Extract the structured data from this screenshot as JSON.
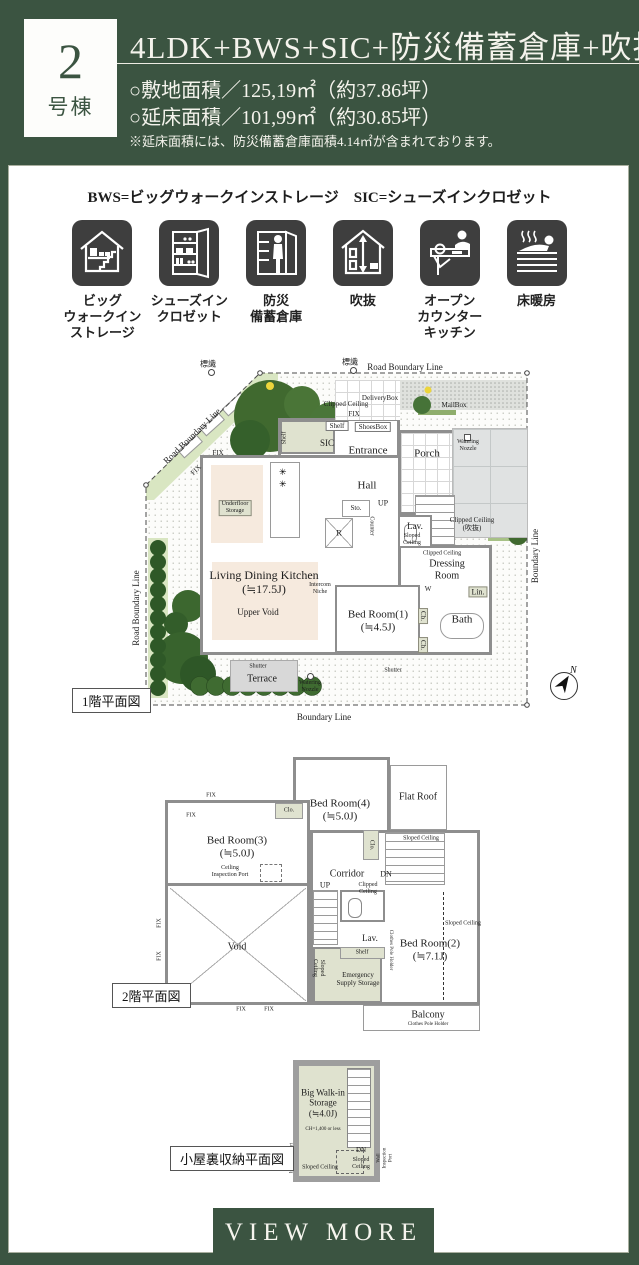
{
  "colors": {
    "bg_green": "#3B5441",
    "icon_dark": "#3E3E3E",
    "wall_gray": "#8E8E8E",
    "storage_fill": "#DFE2CF"
  },
  "header": {
    "badge_number": "2",
    "badge_label": "号棟",
    "title": "4LDK+BWS+SIC+防災備蓄倉庫+吹抜",
    "site_area": "○敷地面積／125,19㎡（約37.86坪）",
    "floor_area": "○延床面積／101,99㎡（約30.85坪）",
    "note": "※延床面積には、防災備蓄倉庫面積4.14㎡が含まれております。"
  },
  "legend": "BWS=ビッグウォークインストレージ　SIC=シューズインクロゼット",
  "features": [
    {
      "icon": "big-walk-in-storage-icon",
      "label": "ビッグ\nウォークイン\nストレージ"
    },
    {
      "icon": "shoes-in-closet-icon",
      "label": "シューズイン\nクロゼット"
    },
    {
      "icon": "disaster-storage-icon",
      "label": "防災\n備蓄倉庫"
    },
    {
      "icon": "open-ceiling-icon",
      "label": "吹抜"
    },
    {
      "icon": "open-counter-kitchen-icon",
      "label": "オープン\nカウンター\nキッチン"
    },
    {
      "icon": "floor-heating-icon",
      "label": "床暖房"
    }
  ],
  "floor1": {
    "plan_label": "1階平面図",
    "labels": {
      "sign": "標識",
      "road_boundary": "Road Boundary Line",
      "boundary": "Boundary Line",
      "delivery_box": "DeliveryBox",
      "mail_box": "MailBox",
      "clipped_ceiling": "Clipped Ceiling",
      "clipped_ceiling_void": "Clipped Ceiling\n(吹抜)",
      "fix": "FIX",
      "shelf": "Shelf",
      "shoes_box": "ShoesBox",
      "sic": "SIC",
      "entrance": "Entrance",
      "porch": "Porch",
      "watering_nozzle": "Watering\nNozzle",
      "hall": "Hall",
      "up": "UP",
      "sto": "Sto.",
      "refrigerator": "R",
      "counter": "Counter",
      "lav": "Lav.",
      "sloped_ceiling": "Sloped\nCeiling",
      "underfloor_storage": "Underfloor\nStorage",
      "ldk": "Living Dining Kitchen\n(≒17.5J)",
      "upper_void": "Upper Void",
      "intercom_niche": "Intercom\nNiche",
      "bedroom1": "Bed Room(1)\n(≒4.5J)",
      "dressing_room": "Dressing\nRoom",
      "w": "W",
      "lin": "Lin.",
      "cb": "Cb.",
      "bath": "Bath",
      "shutter": "Shutter",
      "terrace": "Terrace",
      "north": "N"
    }
  },
  "floor2": {
    "plan_label": "2階平面図",
    "labels": {
      "bedroom4": "Bed Room(4)\n(≒5.0J)",
      "flat_roof": "Flat Roof",
      "bedroom3": "Bed Room(3)\n(≒5.0J)",
      "clo": "Clo.",
      "corridor": "Corridor",
      "dn": "DN",
      "up": "UP",
      "sloped_ceiling": "Sloped Ceiling",
      "sloped_ceiling2": "Sloped\nCeiling",
      "clipped_ceiling": "Clipped\nCeiling",
      "ceiling_inspection_port": "Ceiling\nInspection Port",
      "void": "Void",
      "lav": "Lav.",
      "shelf": "Shelf",
      "emergency_storage": "Emergency\nSupply Storage",
      "bedroom2": "Bed Room(2)\n(≒7.1J)",
      "clothes_pole_holder": "Clothes Pole Holder",
      "balcony": "Balcony",
      "fix": "FIX"
    }
  },
  "attic": {
    "plan_label": "小屋裏収納平面図",
    "labels": {
      "storage": "Big Walk-in\nStorage\n(≒4.0J)",
      "ch": "CH=1,400 or less",
      "dn": "DN",
      "sloped_ceiling": "Sloped Ceiling",
      "sloped_ceiling2": "Sloped\nCeiling",
      "wall_inspection_port": "Wall\nInspection Port"
    }
  },
  "footer": {
    "view_more": "VIEW MORE"
  }
}
